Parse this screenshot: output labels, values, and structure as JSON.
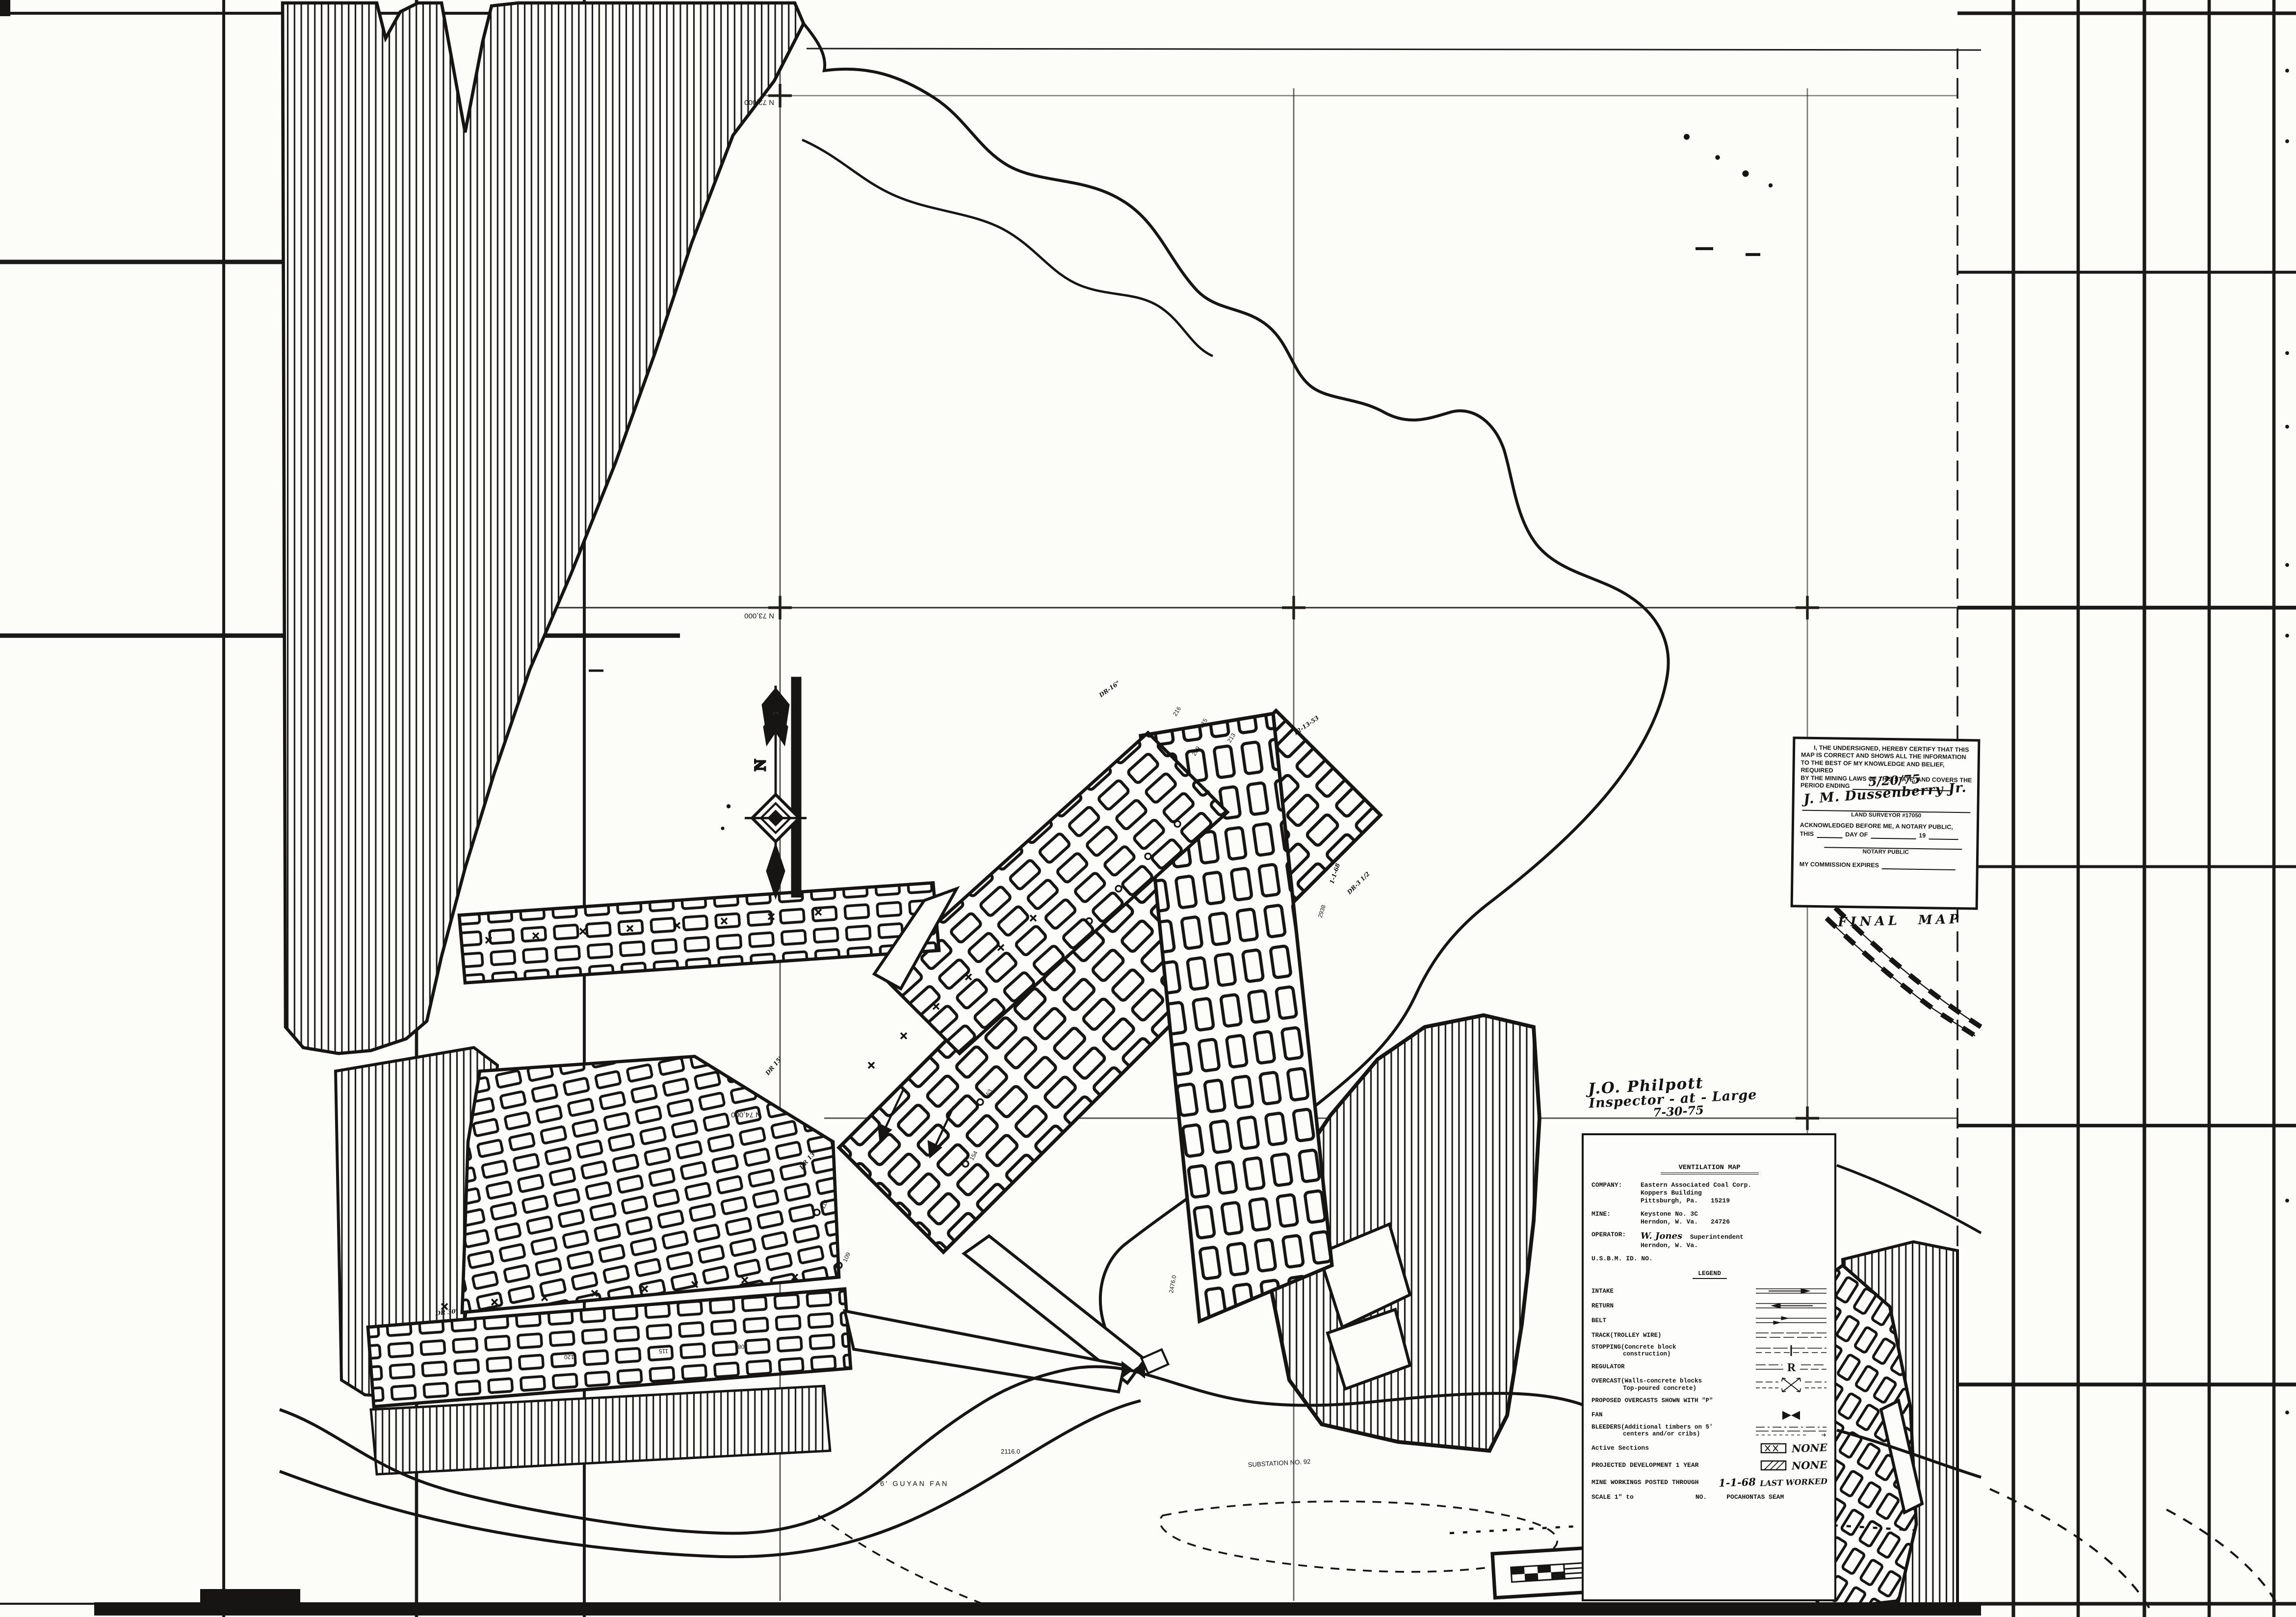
{
  "sheet": {
    "north_label": "N",
    "grid_labels": {
      "n72": "N 72,000",
      "n73": "N 73,000",
      "n74": "N 74,000"
    }
  },
  "surface": {
    "fan_label": "6' GUYAN FAN",
    "substation_label": "SUBSTATION NO. 92",
    "elevation_label": "2116.0"
  },
  "workings_labels": {
    "dr16": "DR-16\"",
    "dr15": "DR 15'",
    "dr13": "DR 13\"",
    "dr30": "DR 30'",
    "dr3": "DR-3 1/2",
    "date1": "12-13-53",
    "date2": "1-1-68",
    "elev2938": "2938",
    "elev2476": "2476.0",
    "e216": "216",
    "e215": "215",
    "e213": "213",
    "e209": "209",
    "p120": "120",
    "p115": "115",
    "p108": "108",
    "s153": "153",
    "s154": "154",
    "s109": "109",
    "s110": "110"
  },
  "inspector_note": {
    "name": "J.O. Philpott",
    "title": "Inspector - at - Large",
    "date": "7-30-75"
  },
  "final_map_label": "FINAL MAP",
  "certificate": {
    "line1": "I, THE UNDERSIGNED, HEREBY CERTIFY THAT THIS",
    "line2": "MAP IS CORRECT AND SHOWS ALL THE INFORMATION",
    "line3": "TO THE BEST OF MY KNOWLEDGE AND BELIEF, REQUIRED",
    "line4": "BY THE MINING LAWS OF THIS STATE, AND COVERS THE",
    "line5": "PERIOD ENDING",
    "period_ending_date": "5/20/75",
    "signature": "J. M. Dussenberry Jr.",
    "surveyor_line": "LAND SURVEYOR #17050",
    "ack_line": "ACKNOWLEDGED BEFORE ME, A NOTARY PUBLIC,",
    "this_label": "THIS",
    "day_of_label": "DAY OF",
    "year_prefix": "19",
    "notary_label": "NOTARY PUBLIC",
    "commission_label": "MY COMMISSION EXPIRES"
  },
  "title_block": {
    "heading": "VENTILATION MAP",
    "company_label": "COMPANY:",
    "company_line1": "Eastern Associated Coal Corp.",
    "company_line2": "Koppers Building",
    "company_line3": "Pittsburgh, Pa.",
    "company_zip": "15219",
    "mine_label": "MINE:",
    "mine_line1": "Keystone No. 3C",
    "mine_line2": "Herndon, W. Va.",
    "mine_id": "24726",
    "operator_label": "OPERATOR:",
    "operator_name": "W. Jones",
    "operator_title": "Superintendent",
    "operator_line2": "Herndon, W. Va.",
    "usbm_label": "U.S.B.M. ID. NO."
  },
  "legend": {
    "heading": "LEGEND",
    "regulator_letter": "R",
    "items": [
      {
        "label": "INTAKE"
      },
      {
        "label": "RETURN"
      },
      {
        "label": "BELT"
      },
      {
        "label": "TRACK(TROLLEY WIRE)"
      },
      {
        "label": "STOPPING(Concrete block",
        "label2": "construction)"
      },
      {
        "label": "REGULATOR"
      },
      {
        "label": "OVERCAST(Walls-concrete blocks",
        "label2": "Top-poured concrete)"
      },
      {
        "label": "PROPOSED OVERCASTS SHOWN WITH \"P\""
      },
      {
        "label": "FAN"
      },
      {
        "label": "BLEEDERS(Additional timbers on 5'",
        "label2": "centers and/or cribs)"
      }
    ],
    "status_rows": [
      {
        "label": "Active Sections",
        "value": "NONE"
      },
      {
        "label": "PROJECTED DEVELOPMENT 1 YEAR",
        "value": "NONE"
      },
      {
        "label": "MINE WORKINGS POSTED THROUGH",
        "value": "1-1-68",
        "value2": "LAST WORKED"
      }
    ],
    "scale_row": {
      "prefix": "SCALE 1\" to",
      "no_label": "NO.",
      "seam": "POCAHONTAS SEAM"
    }
  }
}
